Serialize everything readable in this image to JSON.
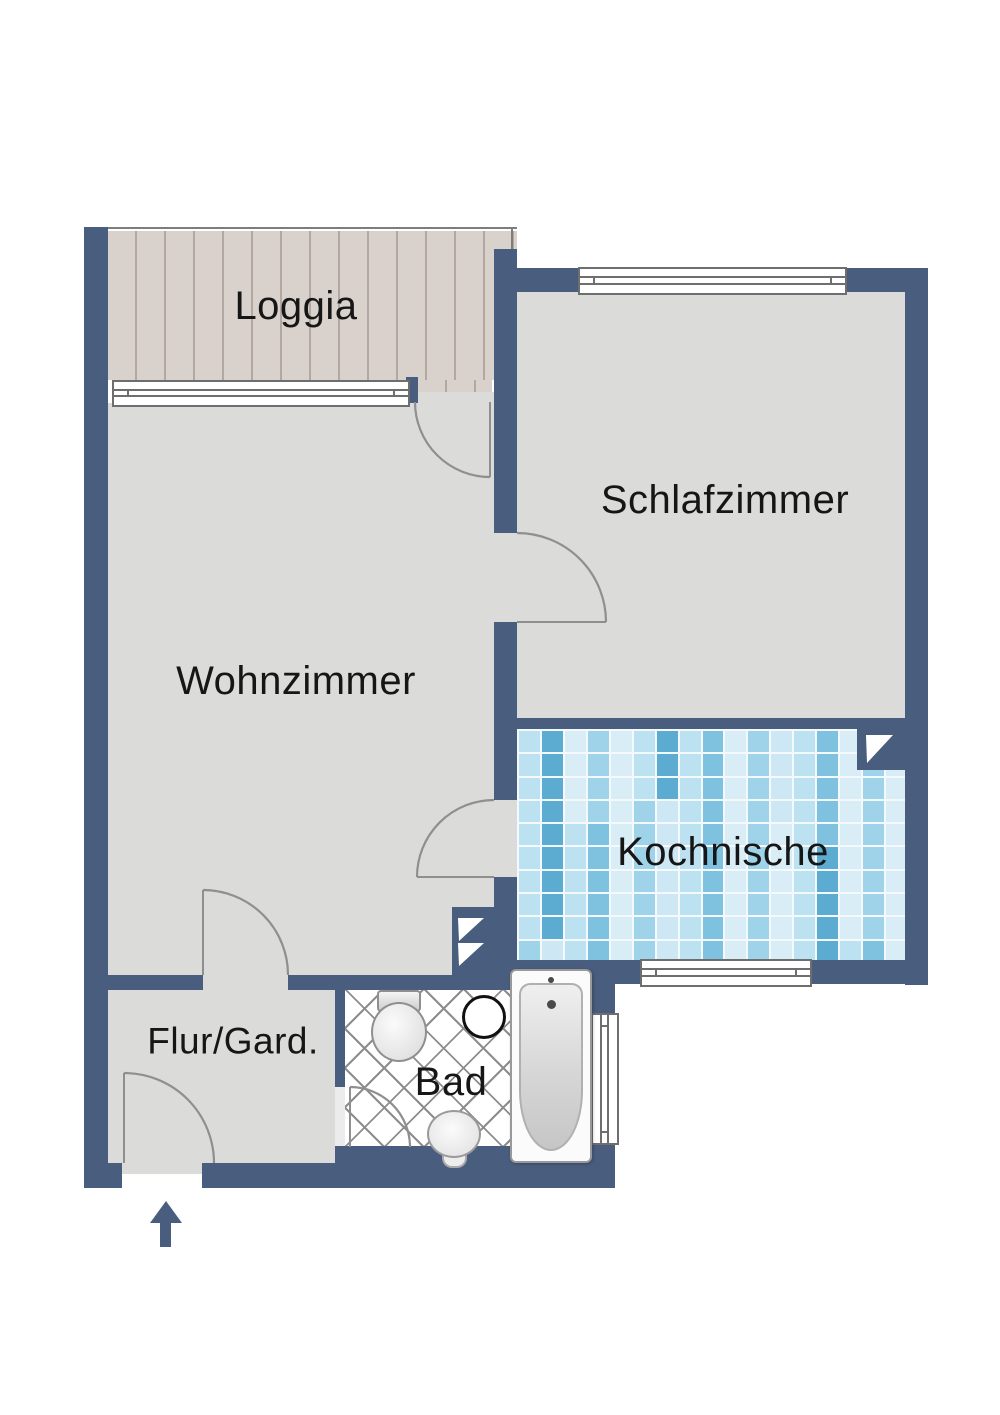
{
  "rooms": {
    "loggia": {
      "label": "Loggia"
    },
    "schlafzimmer": {
      "label": "Schlafzimmer"
    },
    "wohnzimmer": {
      "label": "Wohnzimmer"
    },
    "kochnische": {
      "label": "Kochnische"
    },
    "flur": {
      "label": "Flur/Gard."
    },
    "bad": {
      "label": "Bad"
    }
  },
  "colors": {
    "wall": "#495d7e",
    "floor": "#dbdbd9",
    "wood_base": "#d9d2cc",
    "wood_line": "#b3a8a1",
    "tile_grout": "#f3f9fc",
    "tile_palette": [
      "#d9edf6",
      "#bce1f1",
      "#9ed3ea",
      "#7ec2e0",
      "#5cabd1",
      "#cde8f4"
    ],
    "lattice_line": "#8d8d8d",
    "door_arc": "#8f8f8f",
    "window_frame": "#6e6e6e",
    "label_text": "#161616"
  },
  "symbols": {
    "entrance_arrow_direction": "up"
  }
}
